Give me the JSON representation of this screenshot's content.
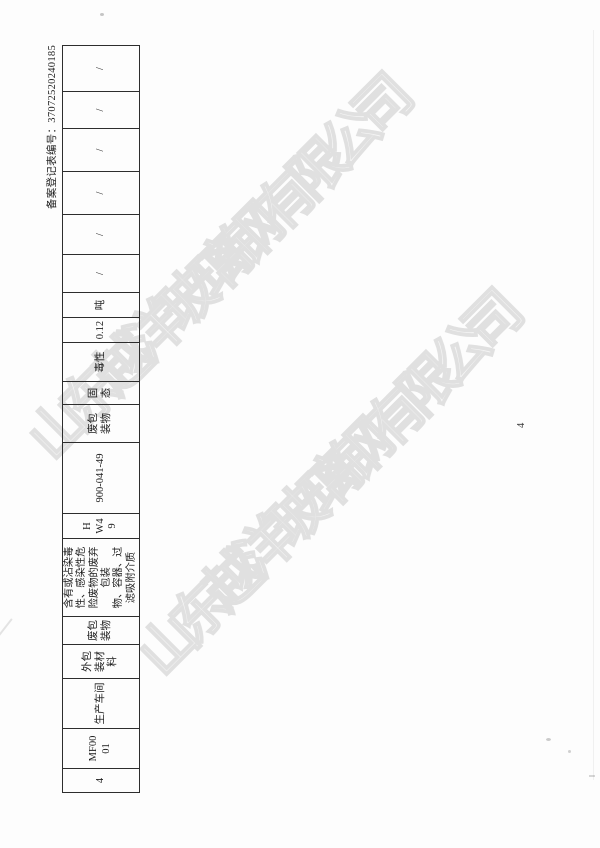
{
  "document": {
    "registration_number": "备案登记表编号：37072520240185",
    "page_number": "4",
    "table": {
      "cells": [
        "4",
        "MF00\n01",
        "生产车间",
        "外包\n装材\n料",
        "废包\n装物",
        "含有或沾染毒\n性、感染性危\n险废物的废弃\n包装\n物、容器、过\n滤吸附介质",
        "H\nW4\n9",
        "900-041-49",
        "废包\n装物",
        "固 态",
        "毒性",
        "0.12",
        "吨",
        "/",
        "/",
        "/",
        "/",
        "/",
        "/"
      ]
    }
  },
  "watermark": {
    "text": "山东越洋玻璃钢有限公司",
    "stroke_color": "#e2e2e2"
  }
}
